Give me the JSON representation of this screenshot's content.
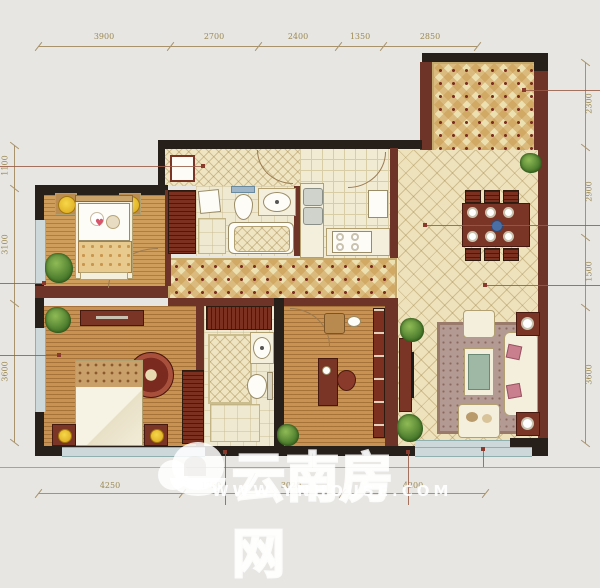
{
  "dimensions": {
    "top": [
      "3900",
      "2700",
      "2400",
      "1350",
      "2850"
    ],
    "bottom": [
      "4250",
      "1750",
      "3020",
      "4200"
    ],
    "left": [
      "1100",
      "3100",
      "3600"
    ],
    "right": [
      "2300",
      "2900",
      "1500",
      "3600"
    ]
  },
  "watermark": {
    "brand": "云南房网",
    "url": "WWW.YNHOUSE.COM"
  },
  "colors": {
    "background": "#e7e6e3",
    "wall_dark": "#27201a",
    "wall_red": "#6f3428",
    "wood_floor": "#c89352",
    "tile_cream": "#ede2bc",
    "window_blue": "#cdd8da",
    "dimension_text": "#9c8952",
    "leader_line": "#9a5a48",
    "furniture_red": "#7a3526",
    "watermark_white": "#ffffff"
  }
}
